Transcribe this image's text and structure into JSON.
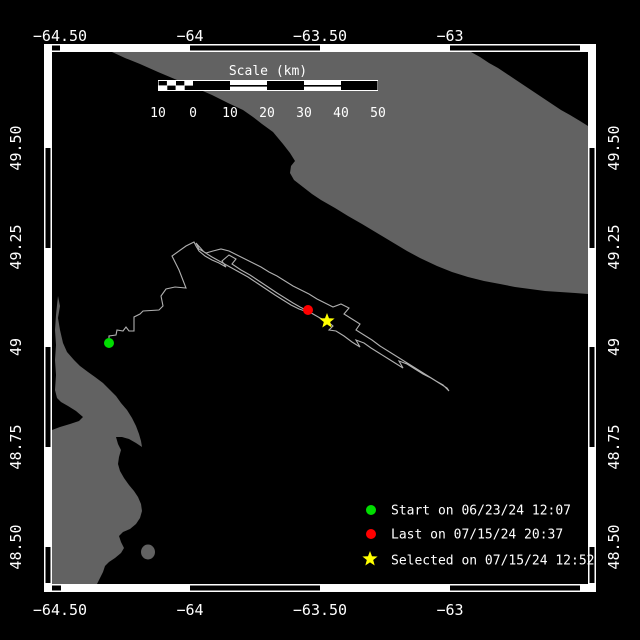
{
  "axis": {
    "lon": [
      "−64.50",
      "−64",
      "−63.50",
      "−63"
    ],
    "lat": [
      "49.50",
      "49.25",
      "49",
      "48.75",
      "48.50"
    ]
  },
  "scalebar": {
    "title": "Scale (km)",
    "ticks": [
      "10",
      "0",
      "10",
      "20",
      "30",
      "40",
      "50"
    ]
  },
  "legend": {
    "start": {
      "label": "Start on 06/23/24 12:07",
      "color": "#00dd00"
    },
    "last": {
      "label": "Last on 07/15/24 20:37",
      "color": "#ff0000"
    },
    "selected": {
      "label": "Selected on 07/15/24 12:52",
      "color": "#ffff00"
    }
  },
  "colors": {
    "water": "#000000",
    "land": "#626262",
    "track": "#b0b0b0",
    "frame": "#ffffff",
    "text": "#ffffff"
  }
}
